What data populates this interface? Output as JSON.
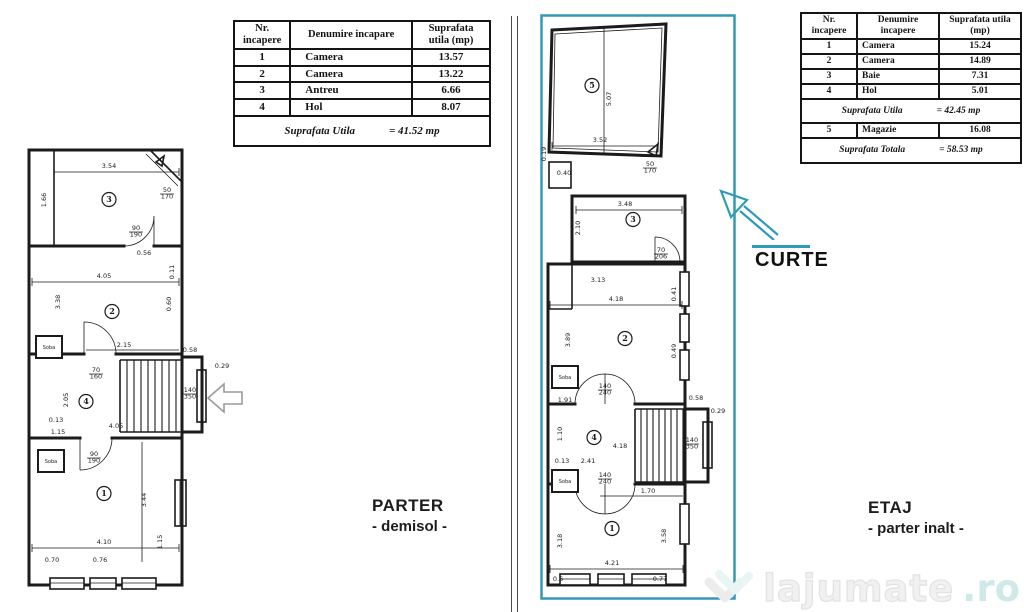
{
  "captions": {
    "parter_title": "PARTER",
    "parter_sub": "- demisol -",
    "etaj_title": "ETAJ",
    "etaj_sub": "- parter inalt -",
    "curte": "CURTE"
  },
  "tables": {
    "parter": {
      "headers": [
        "Nr. incapere",
        "Denumire incapare",
        "Suprafata utila (mp)"
      ],
      "rows": [
        [
          "1",
          "Camera",
          "13.57"
        ],
        [
          "2",
          "Camera",
          "13.22"
        ],
        [
          "3",
          "Antreu",
          "6.66"
        ],
        [
          "4",
          "Hol",
          "8.07"
        ]
      ],
      "total_label": "Suprafata Utila",
      "total_value": "= 41.52 mp"
    },
    "etaj": {
      "headers": [
        "Nr. incapere",
        "Denumire incapere",
        "Suprafata utila (mp)"
      ],
      "rows": [
        [
          "1",
          "Camera",
          "15.24"
        ],
        [
          "2",
          "Camera",
          "14.89"
        ],
        [
          "3",
          "Baie",
          "7.31"
        ],
        [
          "4",
          "Hol",
          "5.01"
        ]
      ],
      "subtotal_label": "Suprafata Utila",
      "subtotal_value": "= 42.45 mp",
      "extra_row": [
        "5",
        "Magazie",
        "16.08"
      ],
      "total_label": "Suprafata Totala",
      "total_value": "= 58.53 mp"
    }
  },
  "watermark": {
    "brand": "lajumate",
    "tld": ".ro"
  },
  "colors": {
    "accent": "#3499b4",
    "ink": "#1b1b1b",
    "watermark_gray": "#ececec",
    "watermark_teal": "#d9eef0"
  },
  "plans": {
    "parter": {
      "labels": [
        {
          "t": "3.54",
          "x": 85,
          "y": 26
        },
        {
          "t": "1.66",
          "x": 22,
          "y": 58,
          "r": -90
        },
        {
          "t": "3",
          "c": 1,
          "x": 85,
          "y": 60
        },
        {
          "t": "50/170",
          "x": 143,
          "y": 50,
          "f": 1
        },
        {
          "t": "90/190",
          "x": 112,
          "y": 88,
          "f": 1
        },
        {
          "t": "0.56",
          "x": 120,
          "y": 113
        },
        {
          "t": "4.05",
          "x": 80,
          "y": 136
        },
        {
          "t": "0.11",
          "x": 150,
          "y": 130,
          "r": -90
        },
        {
          "t": "3.38",
          "x": 36,
          "y": 160,
          "r": -90
        },
        {
          "t": "0.60",
          "x": 147,
          "y": 162,
          "r": -90
        },
        {
          "t": "2",
          "c": 1,
          "x": 88,
          "y": 172
        },
        {
          "t": "2.15",
          "x": 100,
          "y": 205
        },
        {
          "t": "70/160",
          "x": 72,
          "y": 230,
          "f": 1
        },
        {
          "t": "Soba",
          "b": 1,
          "x": 12,
          "y": 194
        },
        {
          "t": "0.58",
          "x": 166,
          "y": 210
        },
        {
          "t": "0.29",
          "x": 198,
          "y": 226
        },
        {
          "t": "2.05",
          "x": 44,
          "y": 258,
          "r": -90
        },
        {
          "t": "4",
          "c": 1,
          "x": 62,
          "y": 262
        },
        {
          "t": "140/350",
          "x": 166,
          "y": 250,
          "f": 1
        },
        {
          "t": "0.13",
          "x": 32,
          "y": 280
        },
        {
          "t": "4.05",
          "x": 92,
          "y": 286
        },
        {
          "t": "1.15",
          "x": 34,
          "y": 292
        },
        {
          "t": "90/190",
          "x": 70,
          "y": 314,
          "f": 1
        },
        {
          "t": "Soba",
          "b": 1,
          "x": 14,
          "y": 308
        },
        {
          "t": "1",
          "c": 1,
          "x": 80,
          "y": 354
        },
        {
          "t": "3.44",
          "x": 122,
          "y": 358,
          "r": -90
        },
        {
          "t": "4.10",
          "x": 80,
          "y": 402
        },
        {
          "t": "1.15",
          "x": 138,
          "y": 400,
          "r": -90
        },
        {
          "t": "0.70",
          "x": 28,
          "y": 420
        },
        {
          "t": "0.76",
          "x": 76,
          "y": 420
        }
      ]
    },
    "etaj": {
      "labels": [
        {
          "t": "5",
          "c": 1,
          "x": 52,
          "y": 74
        },
        {
          "t": "5.07",
          "x": 71,
          "y": 85,
          "r": -90
        },
        {
          "t": "3.52",
          "x": 60,
          "y": 128
        },
        {
          "t": "0.19",
          "x": 6,
          "y": 140,
          "r": -90
        },
        {
          "t": "0.40",
          "x": 24,
          "y": 161
        },
        {
          "t": "50/170",
          "x": 110,
          "y": 152,
          "f": 1
        },
        {
          "t": "3.48",
          "x": 85,
          "y": 192
        },
        {
          "t": "2.10",
          "x": 40,
          "y": 214,
          "r": -90
        },
        {
          "t": "3",
          "c": 1,
          "x": 93,
          "y": 208
        },
        {
          "t": "70/206",
          "x": 121,
          "y": 238,
          "f": 1
        },
        {
          "t": "3.13",
          "x": 58,
          "y": 268
        },
        {
          "t": "4.18",
          "x": 76,
          "y": 287
        },
        {
          "t": "0.41",
          "x": 136,
          "y": 280,
          "r": -90
        },
        {
          "t": "3.89",
          "x": 30,
          "y": 326,
          "r": -90
        },
        {
          "t": "2",
          "c": 1,
          "x": 85,
          "y": 327
        },
        {
          "t": "0.49",
          "x": 136,
          "y": 337,
          "r": -90
        },
        {
          "t": "Soba",
          "b": 1,
          "x": 12,
          "y": 352
        },
        {
          "t": "140/240",
          "x": 65,
          "y": 374,
          "f": 1
        },
        {
          "t": "1.91",
          "x": 25,
          "y": 388
        },
        {
          "t": "0.58",
          "x": 156,
          "y": 386
        },
        {
          "t": "0.29",
          "x": 178,
          "y": 399
        },
        {
          "t": "1.10",
          "x": 22,
          "y": 420,
          "r": -90
        },
        {
          "t": "4",
          "c": 1,
          "x": 54,
          "y": 426
        },
        {
          "t": "4.18",
          "x": 80,
          "y": 434
        },
        {
          "t": "0.13",
          "x": 22,
          "y": 449
        },
        {
          "t": "2.41",
          "x": 48,
          "y": 449
        },
        {
          "t": "140/240",
          "x": 65,
          "y": 463,
          "f": 1
        },
        {
          "t": "140/350",
          "x": 152,
          "y": 428,
          "f": 1
        },
        {
          "t": "1.70",
          "x": 108,
          "y": 479
        },
        {
          "t": "Soba",
          "b": 1,
          "x": 12,
          "y": 456
        },
        {
          "t": "1",
          "c": 1,
          "x": 72,
          "y": 517
        },
        {
          "t": "3.18",
          "x": 22,
          "y": 527,
          "r": -90
        },
        {
          "t": "3.58",
          "x": 126,
          "y": 522,
          "r": -90
        },
        {
          "t": "4.21",
          "x": 72,
          "y": 551
        },
        {
          "t": "0.77",
          "x": 120,
          "y": 567
        },
        {
          "t": "0.6",
          "x": 18,
          "y": 567
        }
      ]
    }
  }
}
